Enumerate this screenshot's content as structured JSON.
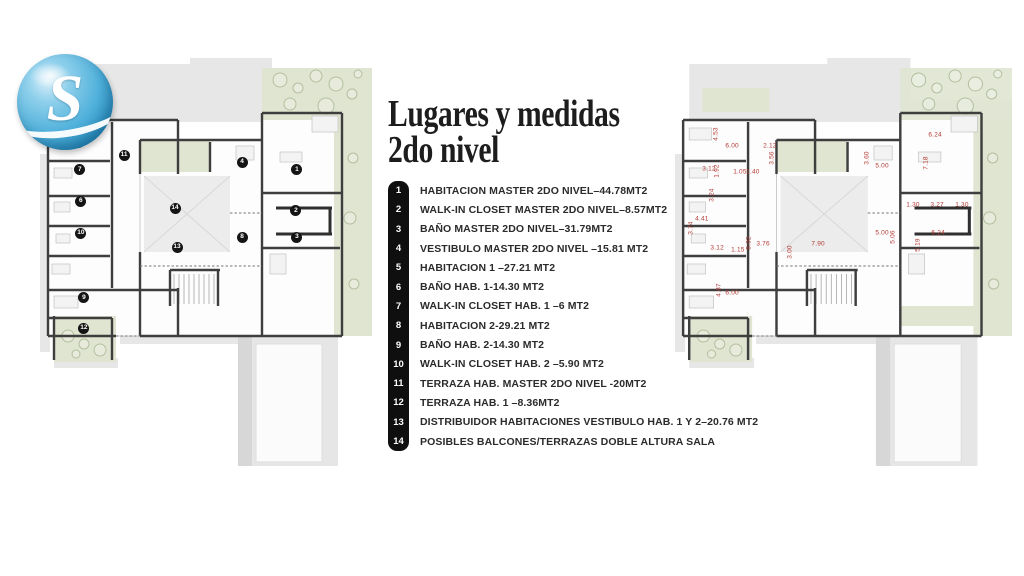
{
  "title": {
    "line1": "Lugares y medidas",
    "line2": "2do nivel"
  },
  "logo": {
    "letter": "S"
  },
  "legend": {
    "items": [
      {
        "num": "1",
        "label": "HABITACION MASTER 2DO NIVEL–44.78MT2"
      },
      {
        "num": "2",
        "label": "WALK-IN CLOSET MASTER 2DO NIVEL–8.57MT2"
      },
      {
        "num": "3",
        "label": "BAÑO MASTER 2DO NIVEL–31.79MT2"
      },
      {
        "num": "4",
        "label": "VESTIBULO MASTER 2DO NIVEL –15.81 MT2"
      },
      {
        "num": "5",
        "label": "HABITACION 1 –27.21 MT2"
      },
      {
        "num": "6",
        "label": "BAÑO HAB. 1-14.30 MT2"
      },
      {
        "num": "7",
        "label": "WALK-IN CLOSET HAB. 1 –6 MT2"
      },
      {
        "num": "8",
        "label": "HABITACION 2-29.21 MT2"
      },
      {
        "num": "9",
        "label": "BAÑO HAB. 2-14.30 MT2"
      },
      {
        "num": "10",
        "label": "WALK-IN CLOSET HAB. 2 –5.90 MT2"
      },
      {
        "num": "11",
        "label": "TERRAZA HAB. MASTER 2DO NIVEL -20MT2"
      },
      {
        "num": "12",
        "label": "TERRAZA HAB. 1 –8.36MT2"
      },
      {
        "num": "13",
        "label": "DISTRIBUIDOR HABITACIONES VESTIBULO HAB. 1 Y 2–20.76 MT2"
      },
      {
        "num": "14",
        "label": "POSIBLES BALCONES/TERRAZAS DOBLE ALTURA SALA"
      }
    ]
  },
  "left_plan": {
    "markers": [
      {
        "n": "1",
        "x": 76.7,
        "y": 27.3
      },
      {
        "n": "2",
        "x": 76.4,
        "y": 37.3
      },
      {
        "n": "3",
        "x": 76.7,
        "y": 43.7
      },
      {
        "n": "4",
        "x": 60.3,
        "y": 25.4
      },
      {
        "n": "5",
        "x": 11.6,
        "y": 20.5
      },
      {
        "n": "6",
        "x": 12.2,
        "y": 34.9
      },
      {
        "n": "7",
        "x": 11.9,
        "y": 27.3
      },
      {
        "n": "8",
        "x": 60.3,
        "y": 43.7
      },
      {
        "n": "9",
        "x": 13.1,
        "y": 58.5
      },
      {
        "n": "10",
        "x": 12.2,
        "y": 42.7
      },
      {
        "n": "11",
        "x": 25.1,
        "y": 23.7
      },
      {
        "n": "12",
        "x": 13.1,
        "y": 65.9
      },
      {
        "n": "13",
        "x": 40.9,
        "y": 46.1
      },
      {
        "n": "14",
        "x": 40.3,
        "y": 36.6
      }
    ]
  },
  "right_plan": {
    "dimensions": [
      {
        "v": "4.53",
        "x": 12.1,
        "y": 18.5,
        "vert": true
      },
      {
        "v": "6.00",
        "x": 16.8,
        "y": 21.5,
        "vert": false
      },
      {
        "v": "2.12",
        "x": 27.9,
        "y": 21.5,
        "vert": false
      },
      {
        "v": "3.56",
        "x": 28.5,
        "y": 24.4,
        "vert": true
      },
      {
        "v": "3.12",
        "x": 10.0,
        "y": 27.1,
        "vert": false
      },
      {
        "v": "1.92",
        "x": 12.4,
        "y": 27.6,
        "vert": true
      },
      {
        "v": "1.05",
        "x": 19.1,
        "y": 27.8,
        "vert": false
      },
      {
        "v": "1.40",
        "x": 22.9,
        "y": 27.8,
        "vert": false
      },
      {
        "v": "3.60",
        "x": 56.5,
        "y": 24.4,
        "vert": true
      },
      {
        "v": "5.00",
        "x": 60.9,
        "y": 26.3,
        "vert": false
      },
      {
        "v": "6.24",
        "x": 76.5,
        "y": 18.8,
        "vert": false
      },
      {
        "v": "7.18",
        "x": 73.8,
        "y": 25.6,
        "vert": true
      },
      {
        "v": "3.24",
        "x": 10.9,
        "y": 33.4,
        "vert": true
      },
      {
        "v": "1.30",
        "x": 70.0,
        "y": 35.9,
        "vert": false
      },
      {
        "v": "3.27",
        "x": 77.1,
        "y": 35.9,
        "vert": false
      },
      {
        "v": "1.30",
        "x": 84.4,
        "y": 35.9,
        "vert": false
      },
      {
        "v": "4.41",
        "x": 7.9,
        "y": 39.3,
        "vert": false
      },
      {
        "v": "3.74",
        "x": 4.7,
        "y": 41.5,
        "vert": true
      },
      {
        "v": "5.00",
        "x": 60.9,
        "y": 42.7,
        "vert": false
      },
      {
        "v": "5.06",
        "x": 64.1,
        "y": 43.7,
        "vert": true
      },
      {
        "v": "6.24",
        "x": 77.4,
        "y": 42.7,
        "vert": false
      },
      {
        "v": "5.02",
        "x": 21.8,
        "y": 45.1,
        "vert": true
      },
      {
        "v": "3.76",
        "x": 25.9,
        "y": 45.4,
        "vert": false
      },
      {
        "v": "7.90",
        "x": 42.1,
        "y": 45.4,
        "vert": false
      },
      {
        "v": "3.00",
        "x": 33.8,
        "y": 47.3,
        "vert": true
      },
      {
        "v": "3.12",
        "x": 12.4,
        "y": 46.3,
        "vert": false
      },
      {
        "v": "1.15",
        "x": 18.5,
        "y": 46.8,
        "vert": false
      },
      {
        "v": "5.19",
        "x": 71.5,
        "y": 45.6,
        "vert": true
      },
      {
        "v": "4.87",
        "x": 12.9,
        "y": 56.6,
        "vert": true
      },
      {
        "v": "6.00",
        "x": 16.8,
        "y": 57.3,
        "vert": false
      }
    ]
  },
  "colors": {
    "wall": "#3e3e3e",
    "green_terrace": "#e0e5d1",
    "gray_massing": "#e7e7e7",
    "dimension_red": "#b23a34",
    "marker_black": "#141414",
    "logo_blue": "#4fb0da"
  }
}
